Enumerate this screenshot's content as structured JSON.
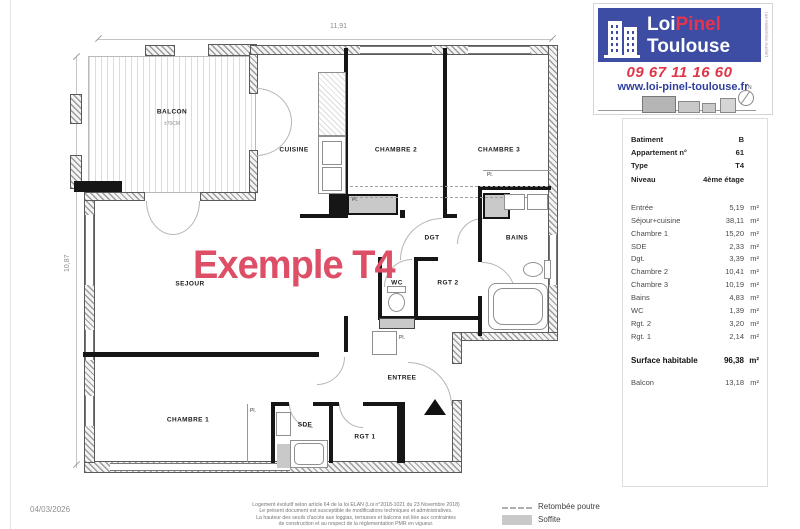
{
  "sheet": {
    "date": "04/03/2026"
  },
  "logo": {
    "brand_top_1": "Loi",
    "brand_top_2": "Pinel",
    "brand_bottom": "Toulouse",
    "phone": "09 67 11 16 60",
    "website": "www.loi-pinel-toulouse.fr",
    "street": "rue Hubertine Auclert",
    "compass": "N"
  },
  "colors": {
    "brand_blue": "#3c4da3",
    "brand_red": "#e8334d",
    "watermark_pink": "#dd4f66",
    "soffite_gray": "#c9c9c9"
  },
  "plan": {
    "watermark": "Exemple T4",
    "dim_width": "11,91",
    "dim_height": "10,87",
    "labels": {
      "balcon": "BALCON",
      "balcon_note": "±70CM",
      "cuisine": "CUISINE",
      "chambre2": "CHAMBRE 2",
      "chambre3": "CHAMBRE 3",
      "dgt": "DGT",
      "bains": "BAINS",
      "wc": "WC",
      "rgt2": "RGT 2",
      "sejour": "SEJOUR",
      "entree": "ENTREE",
      "chambre1": "CHAMBRE 1",
      "sde": "SDE",
      "rgt1": "RGT 1",
      "closet": "Pl."
    }
  },
  "info_panel": {
    "header": [
      {
        "label": "Batiment",
        "value": "B"
      },
      {
        "label": "Appartement n°",
        "value": "61"
      },
      {
        "label": "Type",
        "value": "T4"
      },
      {
        "label": "Niveau",
        "value": "4ème étage"
      }
    ],
    "rooms": [
      {
        "label": "Entrée",
        "value": "5,19",
        "unit": "m²"
      },
      {
        "label": "Séjour+cuisine",
        "value": "38,11",
        "unit": "m²"
      },
      {
        "label": "Chambre 1",
        "value": "15,20",
        "unit": "m²"
      },
      {
        "label": "SDE",
        "value": "2,33",
        "unit": "m²"
      },
      {
        "label": "Dgt.",
        "value": "3,39",
        "unit": "m²"
      },
      {
        "label": "Chambre 2",
        "value": "10,41",
        "unit": "m²"
      },
      {
        "label": "Chambre 3",
        "value": "10,19",
        "unit": "m²"
      },
      {
        "label": "Bains",
        "value": "4,83",
        "unit": "m²"
      },
      {
        "label": "WC",
        "value": "1,39",
        "unit": "m²"
      },
      {
        "label": "Rgt. 2",
        "value": "3,20",
        "unit": "m²"
      },
      {
        "label": "Rgt. 1",
        "value": "2,14",
        "unit": "m²"
      }
    ],
    "total": {
      "label": "Surface habitable",
      "value": "96,38",
      "unit": "m²"
    },
    "extra": {
      "label": "Balcon",
      "value": "13,18",
      "unit": "m²"
    }
  },
  "legend": {
    "items": [
      {
        "label": "Retombée poutre"
      },
      {
        "label": "Soffite"
      }
    ]
  },
  "footer": {
    "disclaimer": [
      "Logement évolutif selon article 64 de la loi ELAN (Loi n°2018-1021 du 23 Novembre 2018)",
      "Le présent document est susceptible de modifications techniques et administratives.",
      "La hauteur des seuils d'accès aux loggias, terrasses et balcons est liée aux contraintes",
      "de construction et au respect de la réglementation PMR en vigueur."
    ]
  }
}
